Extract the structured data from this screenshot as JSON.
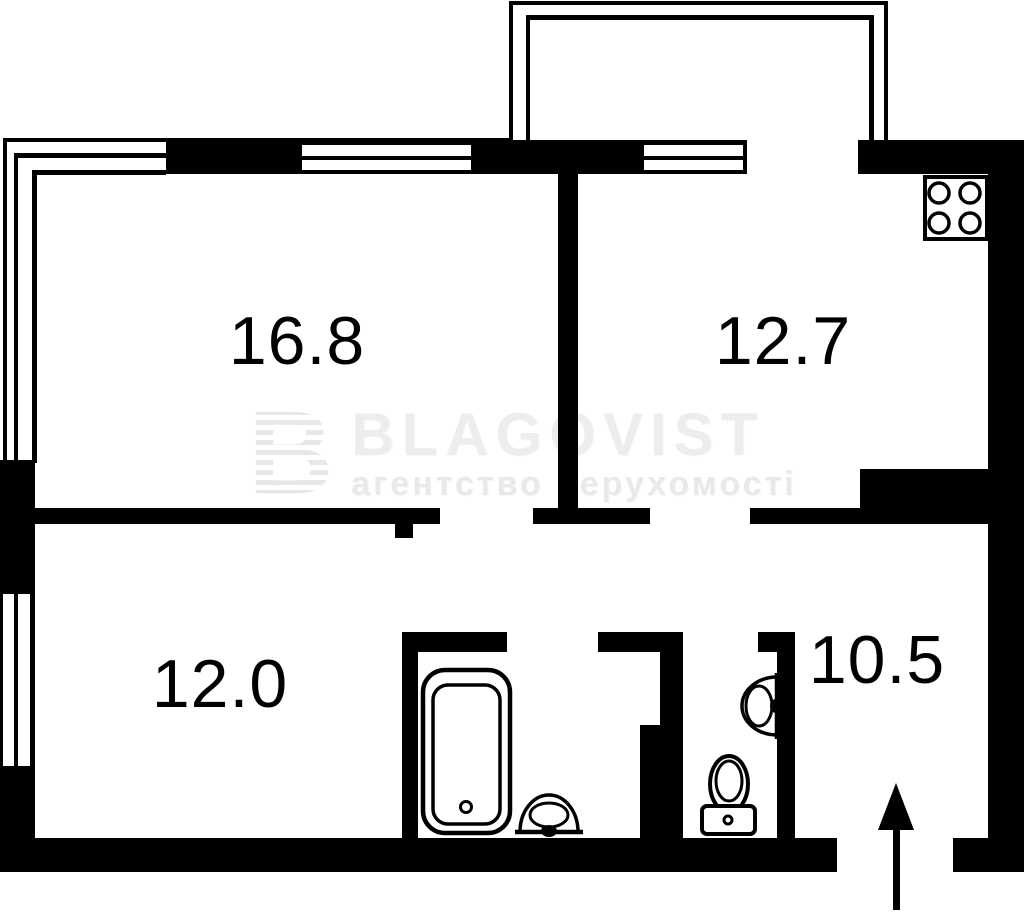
{
  "page": {
    "type": "apartment floor plan"
  },
  "rooms": {
    "living": {
      "area": "16.8"
    },
    "kitchen": {
      "area": "12.7"
    },
    "bedroom": {
      "area": "12.0"
    },
    "hallway": {
      "area": "10.5"
    }
  },
  "watermark": {
    "logo_letter": "B",
    "brand": "BLAGOVIST",
    "tagline": "агентство нерухомості"
  },
  "colors": {
    "wall": "#000000",
    "background": "#ffffff",
    "watermark_text": "#ededed"
  },
  "icons": {
    "stove": "stove-icon",
    "bathtub": "bathtub-icon",
    "bath_sink": "bath-sink-icon",
    "toilet": "toilet-icon",
    "toilet_sink": "toilet-sink-icon",
    "entrance_arrow": "entrance-arrow-icon"
  }
}
